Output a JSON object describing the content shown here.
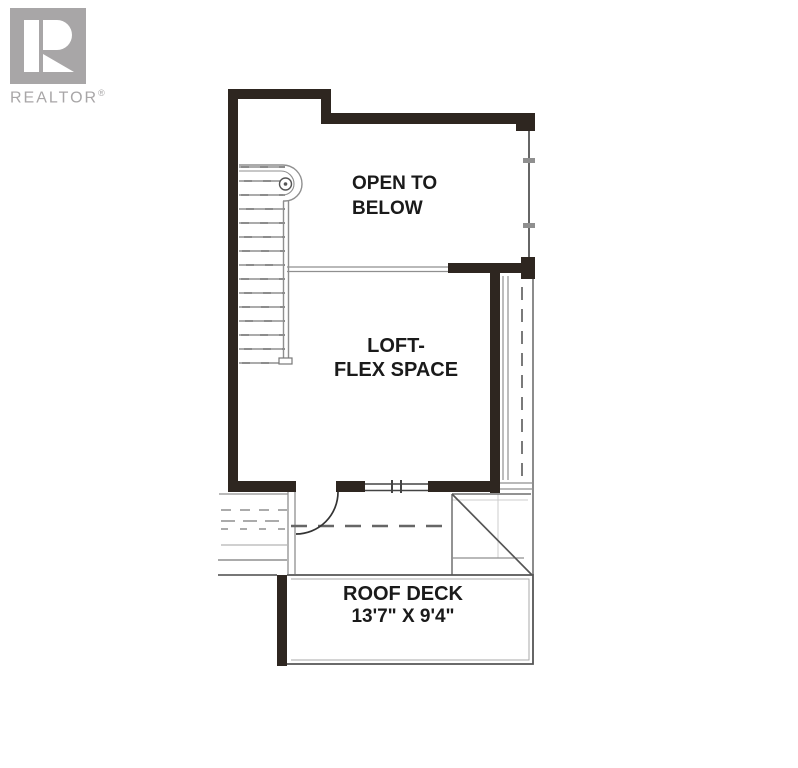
{
  "branding": {
    "logo_text": "REALTOR",
    "registered_mark": "®"
  },
  "floor_plan": {
    "rooms": [
      {
        "id": "open-to-below",
        "label_line1": "OPEN TO",
        "label_line2": "BELOW"
      },
      {
        "id": "loft-flex-space",
        "label_line1": "LOFT-",
        "label_line2": "FLEX SPACE"
      },
      {
        "id": "roof-deck",
        "label_line1": "ROOF DECK",
        "label_line2": "13'7\" X 9'4\""
      }
    ]
  },
  "colors": {
    "background": "#ffffff",
    "wall": "#2e2620",
    "line": "#8f8f8f",
    "line_dark": "#555555",
    "line_darkest": "#333333",
    "line_faint": "#cccccc",
    "text": "#1a1a1a",
    "logo": "#a8a6a7"
  }
}
